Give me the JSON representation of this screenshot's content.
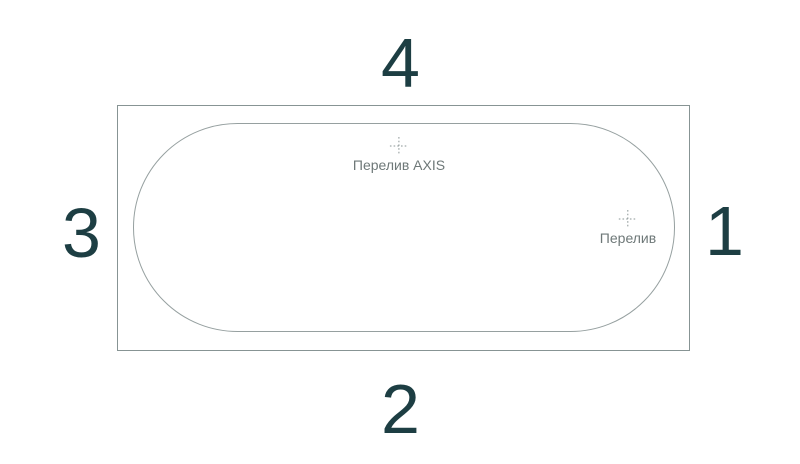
{
  "diagram": {
    "type": "bathtub-top-view-line-drawing",
    "sides": {
      "top": "4",
      "bottom": "2",
      "left": "3",
      "right": "1"
    },
    "markers": [
      {
        "icon": "crosshair-icon",
        "label": "Перелив AXIS"
      },
      {
        "icon": "crosshair-icon",
        "label": "Перелив"
      }
    ],
    "colors": {
      "side_number": "#1d3e43",
      "outline": "#879494",
      "inner_outline": "#96a0a0",
      "marker_label": "#6e7878",
      "crosshair": "#8a9595",
      "background": "#ffffff"
    }
  }
}
